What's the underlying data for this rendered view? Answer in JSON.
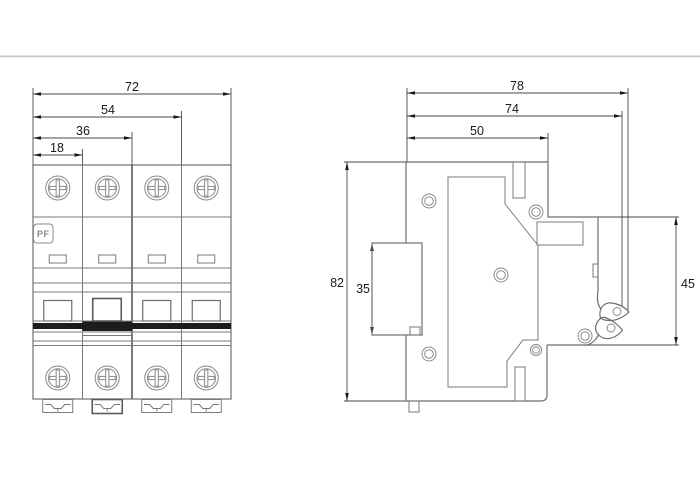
{
  "drawing": {
    "type": "technical-dimension-drawing",
    "subject": "4-pole miniature circuit breaker, front view and side view",
    "divider_color": "#c9c9c9",
    "line_color": "#6e6e6e",
    "dim_text_color": "#1a1a1a",
    "front_view": {
      "poles": 4,
      "logo": "PF",
      "dims": {
        "total_width": "72",
        "three_pole_width": "54",
        "two_pole_width": "36",
        "one_pole_width": "18"
      }
    },
    "side_view": {
      "dims": {
        "total_depth": "78",
        "depth_to_lever": "74",
        "top_depth": "50",
        "total_height": "82",
        "din_rail": "35",
        "front_height": "45"
      }
    }
  }
}
